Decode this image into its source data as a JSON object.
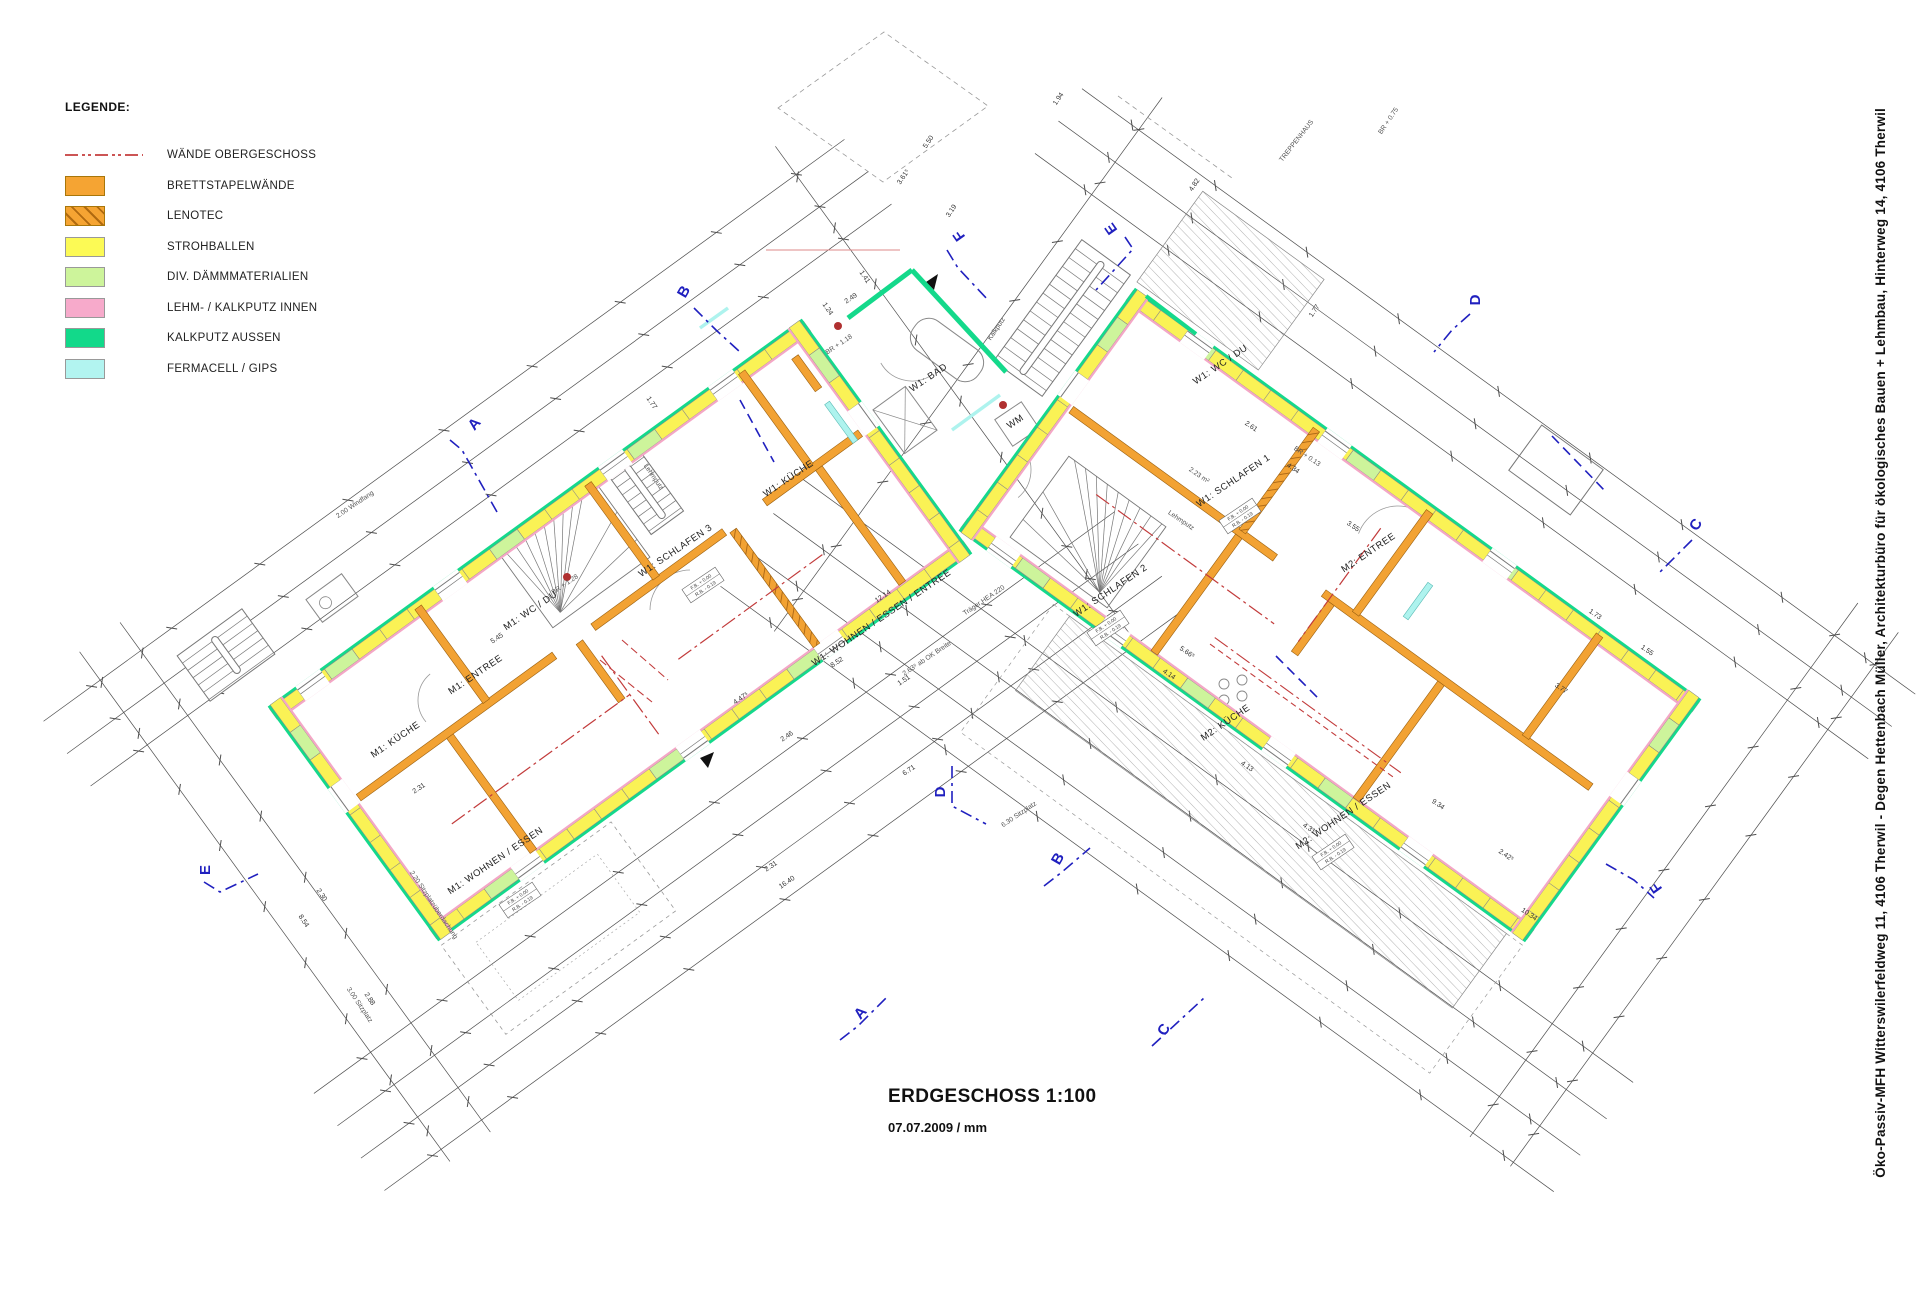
{
  "legend": {
    "title": "LEGENDE:",
    "items": [
      {
        "type": "line",
        "label": "WÄNDE OBERGESCHOSS",
        "color": "#cc5555"
      },
      {
        "type": "swatch",
        "label": "BRETTSTAPELWÄNDE",
        "color": "#F5A433"
      },
      {
        "type": "hatch",
        "label": "LENOTEC",
        "color": "#F5A433",
        "hatch_color": "#b06a10"
      },
      {
        "type": "swatch",
        "label": "STROHBALLEN",
        "color": "#FCFA55"
      },
      {
        "type": "swatch",
        "label": "DIV. DÄMMMATERIALIEN",
        "color": "#CDF49B"
      },
      {
        "type": "swatch",
        "label": "LEHM- / KALKPUTZ INNEN",
        "color": "#F7AACB"
      },
      {
        "type": "swatch",
        "label": "KALKPUTZ AUSSEN",
        "color": "#12D98A"
      },
      {
        "type": "swatch",
        "label": "FERMACELL / GIPS",
        "color": "#B2F4F0"
      }
    ]
  },
  "title_block": {
    "title": "ERDGESCHOSS 1:100",
    "subtitle": "07.07.2009 / mm"
  },
  "sidebar": {
    "project_line": "Öko-Passiv-MFH Witterswilerfeldweg 11, 4106 Therwil - Degen Hettenbach Müller, Architekturbüro für ökologisches Bauen + Lehmbau, Hinterweg 14, 4106 Therwil"
  },
  "plan": {
    "colors": {
      "orange": "#F2A233",
      "orange_dark": "#9A6010",
      "yellow": "#FAF255",
      "light_green": "#CDF49B",
      "pink": "#F4A7C6",
      "green": "#14D98B",
      "cyan": "#AEF3EE",
      "red_upper": "#C23B3B",
      "blue": "#2020BF",
      "dim": "#4d4d4d",
      "thin": "#8a8a8a",
      "dot_red": "#B03030"
    },
    "room_labels": [
      {
        "t": "W1: SCHLAFEN 3",
        "x": 677,
        "y": 553,
        "r": -34
      },
      {
        "t": "W1: KÜCHE",
        "x": 790,
        "y": 481,
        "r": -34
      },
      {
        "t": "W1: WOHNEN / ESSEN / ENTREE",
        "x": 883,
        "y": 620,
        "r": -34
      },
      {
        "t": "W1: BAD",
        "x": 930,
        "y": 380,
        "r": -34
      },
      {
        "t": "WM",
        "x": 1017,
        "y": 424,
        "r": -34
      },
      {
        "t": "M1: KÜCHE",
        "x": 397,
        "y": 742,
        "r": -34
      },
      {
        "t": "M1: ENTREE",
        "x": 477,
        "y": 677,
        "r": -34
      },
      {
        "t": "M1: WC / DU",
        "x": 532,
        "y": 613,
        "r": -34
      },
      {
        "t": "M1: WOHNEN / ESSEN",
        "x": 497,
        "y": 863,
        "r": -34
      },
      {
        "t": "W1: WC / DU",
        "x": 1222,
        "y": 367,
        "r": -34
      },
      {
        "t": "W1: SCHLAFEN 1",
        "x": 1235,
        "y": 483,
        "r": -34
      },
      {
        "t": "W1: SCHLAFEN 2",
        "x": 1112,
        "y": 593,
        "r": -34
      },
      {
        "t": "M2: ENTREE",
        "x": 1370,
        "y": 555,
        "r": -34
      },
      {
        "t": "M2: KÜCHE",
        "x": 1227,
        "y": 725,
        "r": -34
      },
      {
        "t": "M2: WOHNEN / ESSEN",
        "x": 1345,
        "y": 818,
        "r": -34
      }
    ],
    "annotations": [
      {
        "t": "TREPPENHAUS",
        "x": 1298,
        "y": 142,
        "r": -52
      },
      {
        "t": "Träger HEA 220",
        "x": 985,
        "y": 602,
        "r": -34
      },
      {
        "t": "Lehmputz",
        "x": 652,
        "y": 478,
        "r": 56
      },
      {
        "t": "Lehmputz",
        "x": 1180,
        "y": 522,
        "r": 34
      },
      {
        "t": "Kalkputz",
        "x": 998,
        "y": 330,
        "r": -56
      },
      {
        "t": "BR + 1.18",
        "x": 840,
        "y": 346,
        "r": -34
      },
      {
        "t": "BR + 0.75",
        "x": 1390,
        "y": 122,
        "r": -56
      },
      {
        "t": "BR + 0.13",
        "x": 1306,
        "y": 458,
        "r": 34
      },
      {
        "t": "BR + 1.28",
        "x": 566,
        "y": 586,
        "r": -34
      },
      {
        "t": "2.00 Windfang",
        "x": 356,
        "y": 506,
        "r": -34
      },
      {
        "t": "2.63⁵ ab OK Breite",
        "x": 928,
        "y": 660,
        "r": -34
      },
      {
        "t": "3.00 Sitzplatz",
        "x": 358,
        "y": 1006,
        "r": 56
      },
      {
        "t": "2.20 Sitzplatzüberdachung",
        "x": 432,
        "y": 906,
        "r": 56
      },
      {
        "t": "6.30 Sitzplatz",
        "x": 1020,
        "y": 816,
        "r": -34
      },
      {
        "t": "2.23 m²",
        "x": 1198,
        "y": 477,
        "r": 34
      }
    ],
    "fb_boxes": [
      {
        "l1": "F.B. + 0.00",
        "l2": "R.B. - 0.19",
        "x": 703,
        "y": 585,
        "r": -34
      },
      {
        "l1": "F.B. + 0.00",
        "l2": "R.B. - 0.19",
        "x": 1240,
        "y": 516,
        "r": -34
      },
      {
        "l1": "F.B. + 0.00",
        "l2": "R.B. - 0.19",
        "x": 1108,
        "y": 628,
        "r": -34
      },
      {
        "l1": "F.B. + 0.00",
        "l2": "R.B. - 0.19",
        "x": 1333,
        "y": 852,
        "r": -34
      },
      {
        "l1": "F.B. + 0.00",
        "l2": "R.B. - 0.19",
        "x": 520,
        "y": 900,
        "r": -34
      }
    ],
    "dimensions": [
      {
        "t": "12.14",
        "x": 884,
        "y": 598,
        "r": -34
      },
      {
        "t": "8.52",
        "x": 838,
        "y": 664,
        "r": -34
      },
      {
        "t": "1.51",
        "x": 905,
        "y": 682,
        "r": -34
      },
      {
        "t": "4.47⁵",
        "x": 742,
        "y": 700,
        "r": -34
      },
      {
        "t": "2.46",
        "x": 788,
        "y": 738,
        "r": -34
      },
      {
        "t": "16.40",
        "x": 788,
        "y": 884,
        "r": -34
      },
      {
        "t": "2.31",
        "x": 772,
        "y": 868,
        "r": -34
      },
      {
        "t": "5.45",
        "x": 498,
        "y": 640,
        "r": -34
      },
      {
        "t": "2.31",
        "x": 420,
        "y": 790,
        "r": -34
      },
      {
        "t": "3.72",
        "x": 523,
        "y": 906,
        "r": -34
      },
      {
        "t": "6.71",
        "x": 910,
        "y": 772,
        "r": -34
      },
      {
        "t": "2.49",
        "x": 852,
        "y": 300,
        "r": -34
      },
      {
        "t": "1.41",
        "x": 863,
        "y": 278,
        "r": 56
      },
      {
        "t": "1.24",
        "x": 826,
        "y": 310,
        "r": 56
      },
      {
        "t": "1.77",
        "x": 650,
        "y": 404,
        "r": 56
      },
      {
        "t": "8.54",
        "x": 302,
        "y": 922,
        "r": 56
      },
      {
        "t": "2.30",
        "x": 320,
        "y": 896,
        "r": 56
      },
      {
        "t": "2.88",
        "x": 368,
        "y": 1000,
        "r": 56
      },
      {
        "t": "2.61",
        "x": 1250,
        "y": 428,
        "r": 34
      },
      {
        "t": "4.34",
        "x": 1292,
        "y": 470,
        "r": 34
      },
      {
        "t": "3.55",
        "x": 1352,
        "y": 528,
        "r": 34
      },
      {
        "t": "4.14",
        "x": 1168,
        "y": 676,
        "r": 34
      },
      {
        "t": "5.66⁵",
        "x": 1186,
        "y": 654,
        "r": 34
      },
      {
        "t": "4.13",
        "x": 1246,
        "y": 768,
        "r": 34
      },
      {
        "t": "4.31",
        "x": 1308,
        "y": 830,
        "r": 34
      },
      {
        "t": "9.34",
        "x": 1437,
        "y": 806,
        "r": 34
      },
      {
        "t": "10.34",
        "x": 1528,
        "y": 916,
        "r": 34
      },
      {
        "t": "3.77",
        "x": 1560,
        "y": 690,
        "r": 34
      },
      {
        "t": "1.73",
        "x": 1594,
        "y": 616,
        "r": 34
      },
      {
        "t": "1.55",
        "x": 1646,
        "y": 652,
        "r": 34
      },
      {
        "t": "2.42⁵",
        "x": 1505,
        "y": 857,
        "r": 34
      },
      {
        "t": "4.82",
        "x": 1196,
        "y": 186,
        "r": -56
      },
      {
        "t": "1.77",
        "x": 1316,
        "y": 312,
        "r": -56
      },
      {
        "t": "5.50",
        "x": 930,
        "y": 143,
        "r": -56
      },
      {
        "t": "3.61⁵",
        "x": 905,
        "y": 178,
        "r": -56
      },
      {
        "t": "3.19",
        "x": 953,
        "y": 212,
        "r": -56
      },
      {
        "t": "1.94",
        "x": 1060,
        "y": 100,
        "r": -56
      }
    ],
    "section_markers": [
      {
        "t": "A",
        "x": 478,
        "y": 427,
        "r": -50,
        "pts": [
          [
            450,
            440
          ],
          [
            462,
            450
          ],
          [
            497,
            512
          ]
        ]
      },
      {
        "t": "B",
        "x": 688,
        "y": 294,
        "r": -60,
        "pts": [
          [
            694,
            308
          ],
          [
            716,
            330
          ],
          [
            740,
            352
          ]
        ]
      },
      {
        "t": "E",
        "x": 1115,
        "y": 226,
        "r": -125,
        "pts": [
          [
            1125,
            237
          ],
          [
            1133,
            249
          ],
          [
            1096,
            290
          ]
        ]
      },
      {
        "t": "F",
        "x": 963,
        "y": 233,
        "r": -125,
        "pts": [
          [
            947,
            250
          ],
          [
            958,
            268
          ],
          [
            988,
            300
          ]
        ]
      },
      {
        "t": "D",
        "x": 1480,
        "y": 300,
        "r": -90,
        "pts": [
          [
            1470,
            314
          ],
          [
            1452,
            330
          ],
          [
            1434,
            352
          ]
        ]
      },
      {
        "t": "C",
        "x": 1700,
        "y": 527,
        "r": -60,
        "pts": [
          [
            1692,
            540
          ],
          [
            1676,
            556
          ],
          [
            1660,
            572
          ]
        ]
      },
      {
        "t": "E",
        "x": 210,
        "y": 870,
        "r": -90,
        "pts": [
          [
            204,
            882
          ],
          [
            220,
            892
          ],
          [
            258,
            874
          ]
        ]
      },
      {
        "t": "A",
        "x": 864,
        "y": 1016,
        "r": -50,
        "pts": [
          [
            840,
            1040
          ],
          [
            858,
            1026
          ],
          [
            886,
            998
          ]
        ]
      },
      {
        "t": "B",
        "x": 1062,
        "y": 861,
        "r": -60,
        "pts": [
          [
            1044,
            886
          ],
          [
            1062,
            872
          ],
          [
            1090,
            848
          ]
        ]
      },
      {
        "t": "C",
        "x": 1168,
        "y": 1032,
        "r": -60,
        "pts": [
          [
            1152,
            1046
          ],
          [
            1178,
            1022
          ],
          [
            1204,
            998
          ]
        ]
      },
      {
        "t": "D",
        "x": 945,
        "y": 792,
        "r": -90,
        "pts": [
          [
            952,
            766
          ],
          [
            952,
            806
          ],
          [
            986,
            824
          ]
        ]
      },
      {
        "t": "F",
        "x": 1660,
        "y": 885,
        "r": -125,
        "pts": [
          [
            1606,
            864
          ],
          [
            1634,
            880
          ],
          [
            1654,
            898
          ]
        ]
      }
    ]
  }
}
